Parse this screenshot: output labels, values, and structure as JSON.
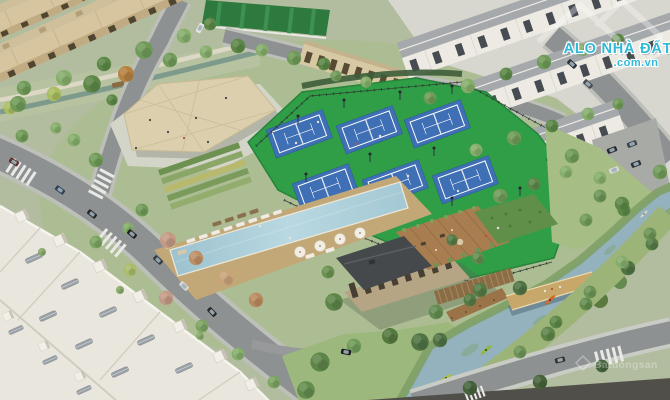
{
  "meta": {
    "type": "aerial-3d-architectural-render",
    "description": "Aerial rendering of a residential masterplan amenity core with tennis courts, lap pool, clubhouse, canopy plaza, kayak canal and townhouse rows"
  },
  "watermarks": {
    "alonhadat": {
      "title": "ALO NHÀ ĐẤT",
      "domain": ".com.vn",
      "fill": "#31b9d8",
      "outline": "#ffffff"
    },
    "batdongsan": {
      "text": "Batdongsan"
    }
  },
  "scene": {
    "features": [
      "beige-townhouse-rows",
      "white-townhouse-rows",
      "flat-roof-townhouses",
      "tennis-courts",
      "lap-pool",
      "pool-umbrellas",
      "clubhouse-rooftop-deck",
      "tensile-canopy-plaza",
      "linear-park-stream",
      "kayak-canal",
      "wooden-bridge",
      "roads-with-crosswalks",
      "parked-cars",
      "street-trees"
    ],
    "palette": {
      "tennis_court_blue": "#3f6fb5",
      "tennis_apron_green": "#2f9e47",
      "pool_water": "#aecfdb",
      "canal_water": "#93b2bd",
      "road_asphalt": "#8e9192",
      "house_beige": "#d6c59f",
      "house_white": "#eceae3",
      "deck_wood": "#a87e50",
      "tree_green": "#6f9a58"
    }
  }
}
